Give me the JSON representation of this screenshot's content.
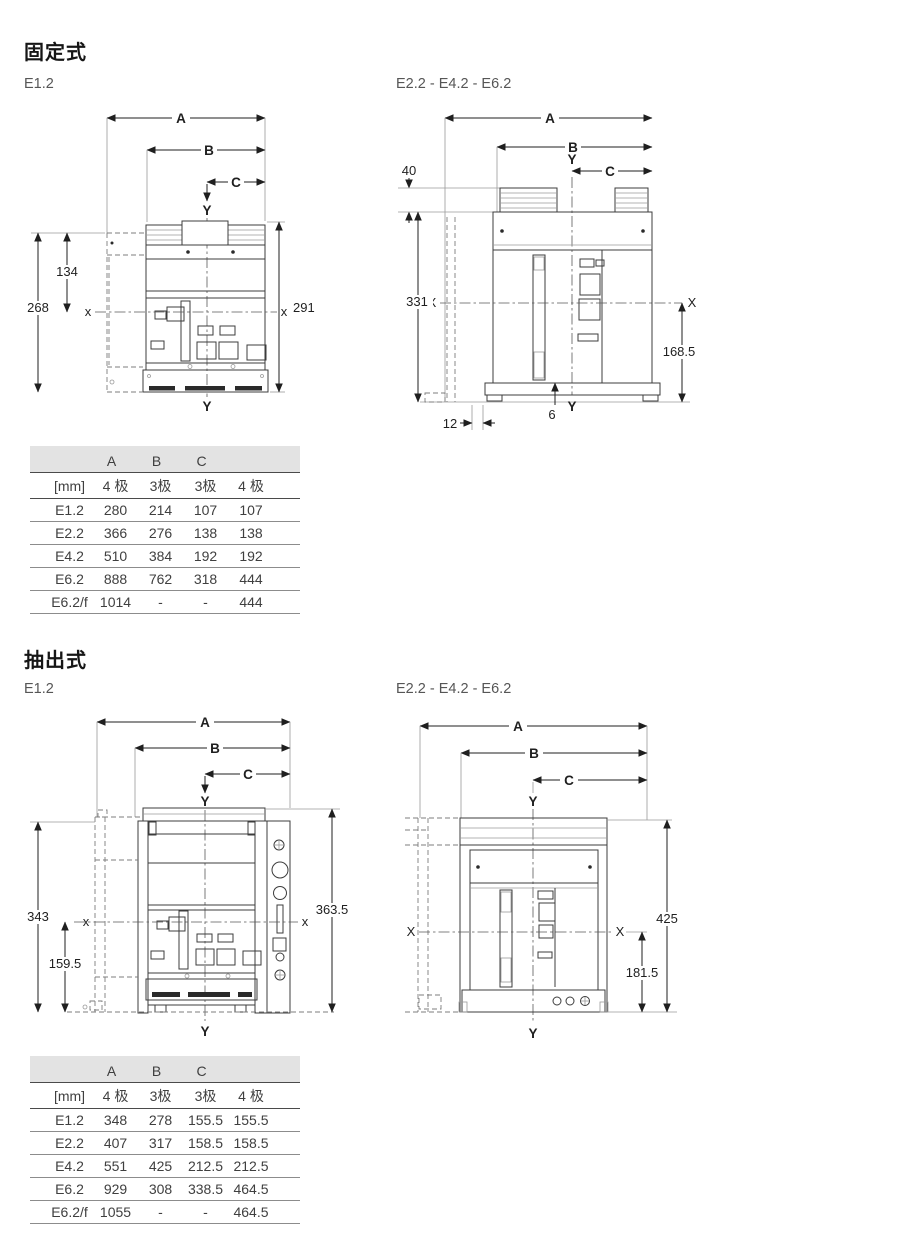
{
  "colors": {
    "table_header_grey": "#e3e3e3",
    "line_dark": "#3c3c3c",
    "text_grey": "#3f3f3f"
  },
  "sections": {
    "fixed": {
      "title": "固定式",
      "caption_left": "E1.2",
      "caption_right": "E2.2 - E4.2 - E6.2",
      "drawing_left": {
        "dim_a": "A",
        "dim_b": "B",
        "dim_c": "C",
        "y_top": "Y",
        "y_bottom": "Y",
        "x_left": "x",
        "x_right": "x",
        "height_inner": "134",
        "height_left": "268",
        "height_right": "291"
      },
      "drawing_right": {
        "dim_a": "A",
        "dim_b": "B",
        "dim_c": "C",
        "y_top": "Y",
        "y_bottom": "Y",
        "x_left": "X",
        "x_right": "X",
        "terminal_height": "40",
        "height_left": "331",
        "height_lower_right": "168.5",
        "base_gap": "6",
        "foot_offset": "12"
      },
      "table": {
        "letter_headers": [
          "A",
          "B",
          "C"
        ],
        "unit_row": [
          "[mm]",
          "4 极",
          "3极",
          "3极",
          "4 极"
        ],
        "rows": [
          [
            "E1.2",
            "280",
            "214",
            "107",
            "107"
          ],
          [
            "E2.2",
            "366",
            "276",
            "138",
            "138"
          ],
          [
            "E4.2",
            "510",
            "384",
            "192",
            "192"
          ],
          [
            "E6.2",
            "888",
            "762",
            "318",
            "444"
          ],
          [
            "E6.2/f",
            "1014",
            "-",
            "-",
            "444"
          ]
        ]
      }
    },
    "drawout": {
      "title": "抽出式",
      "caption_left": "E1.2",
      "caption_right": "E2.2 - E4.2 - E6.2",
      "drawing_left": {
        "dim_a": "A",
        "dim_b": "B",
        "dim_c": "C",
        "y_top": "Y",
        "y_bottom": "Y",
        "x_left": "x",
        "x_right": "x",
        "height_left": "343",
        "height_lower_left": "159.5",
        "height_right": "363.5"
      },
      "drawing_right": {
        "dim_a": "A",
        "dim_b": "B",
        "dim_c": "C",
        "y_top": "Y",
        "y_bottom": "Y",
        "x_left": "X",
        "x_right": "X",
        "height_right": "425",
        "height_lower_right": "181.5"
      },
      "table": {
        "letter_headers": [
          "A",
          "B",
          "C"
        ],
        "unit_row": [
          "[mm]",
          "4 极",
          "3极",
          "3极",
          "4 极"
        ],
        "rows": [
          [
            "E1.2",
            "348",
            "278",
            "155.5",
            "155.5"
          ],
          [
            "E2.2",
            "407",
            "317",
            "158.5",
            "158.5"
          ],
          [
            "E4.2",
            "551",
            "425",
            "212.5",
            "212.5"
          ],
          [
            "E6.2",
            "929",
            "308",
            "338.5",
            "464.5"
          ],
          [
            "E6.2/f",
            "1055",
            "-",
            "-",
            "464.5"
          ]
        ]
      }
    }
  }
}
